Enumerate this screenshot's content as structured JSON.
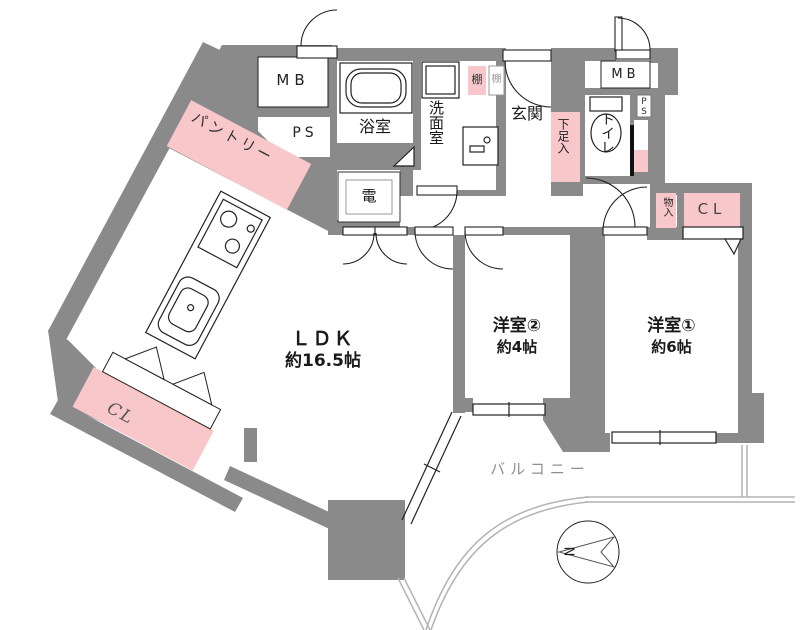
{
  "floorplan": {
    "rooms": {
      "ldk": {
        "name": "ＬＤＫ",
        "size": "約16.5帖"
      },
      "bedroom2": {
        "name": "洋室②",
        "size": "約4帖"
      },
      "bedroom1": {
        "name": "洋室①",
        "size": "約6帖"
      },
      "bath": {
        "name": "浴室"
      },
      "washroom": {
        "name": "洗面室"
      },
      "entrance": {
        "name": "玄関"
      },
      "toilet": {
        "name": "トイレ"
      },
      "pantry": {
        "name": "パントリー"
      },
      "balcony": {
        "name": "バルコニー"
      }
    },
    "storage": {
      "closet_bedroom1": {
        "name": "CL"
      },
      "closet_ldk": {
        "name": "CL"
      },
      "shoe_box": {
        "name": "下足入"
      },
      "small_storage": {
        "name": "物入"
      },
      "shelf_a": {
        "name": "棚"
      },
      "shelf_b": {
        "name": "棚"
      }
    },
    "utility": {
      "meter_box_left": {
        "name": "MB"
      },
      "meter_box_right": {
        "name": "MB"
      },
      "pipe_space_left": {
        "name": "PS"
      },
      "pipe_space_right": {
        "name": "PS"
      },
      "electric_closet": {
        "name": "電"
      }
    },
    "compass": {
      "north": "N"
    },
    "colors": {
      "wall": "#8a8a8a",
      "storage_pink": "#f8c7ca",
      "balcony_line": "#b3b3b3",
      "line": "#222222"
    }
  }
}
